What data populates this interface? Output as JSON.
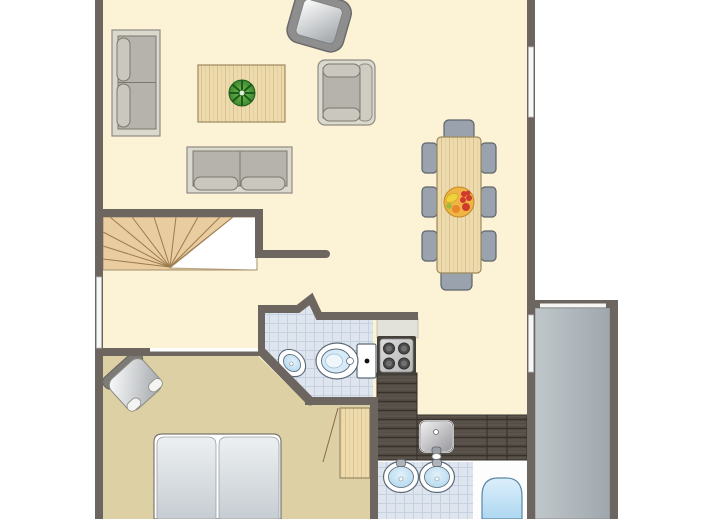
{
  "colors": {
    "white": "#ffffff",
    "wall": "#6d6560",
    "floorMain": "#fcf2d5",
    "floorBedroom": "#ddd0a4",
    "tileFloor": "#dfe5ee",
    "tileLine": "#c6d1e0",
    "terraceEdge": "#8d9499",
    "woodLight": "#eddbae",
    "woodGrain": "#c2a068",
    "stairsWood": "#e9cda0",
    "stairTread": "#9c7a4e",
    "counterDark": "#554e46",
    "counterSeam": "#332e29",
    "sofaFrame": "#dbd8ce",
    "sofaCushion": "#b6b3ac",
    "sofaPillow": "#cac7bf",
    "sofaEdge": "#7b786f",
    "chairGray": "#9aa3ad",
    "chairEdge": "#5d646c",
    "fixtureLine": "#5a6a78",
    "stoveDark": "#44403a",
    "burner": "#4c4c4c",
    "plantGreen": "#3f9e3f",
    "plantDark": "#1d5a1d",
    "bowl": "#f0b445",
    "bowlEdge": "#c08a28",
    "fruitRed": "#d03a2e",
    "fruitYellow": "#f2d23c",
    "fruitOrange": "#e8872c",
    "fruitGreen": "#a2b83a",
    "windowGlass": "#f7f7f7",
    "windowEdge": "#b9b9b9"
  },
  "objects": {
    "living_sofa_large": "two-seat sofa",
    "living_sofa_small": "two-seat sofa",
    "armchair": "armchair",
    "coffee_table": "coffee table",
    "plant": "plant",
    "tv": "corner tv",
    "dining_table": "dining table",
    "dining_chair": "dining chair",
    "fruit_bowl": "fruit bowl",
    "stairs": "winder staircase",
    "toilet": "toilet",
    "corner_sink": "corner hand basin",
    "stove": "cooktop",
    "kitchen_sink": "kitchen sink",
    "counter": "kitchen counter",
    "bed": "double bed",
    "bedroom_chair": "armchair",
    "door": "door leaf",
    "washbasin": "washbasin",
    "bathtub": "bathtub",
    "terrace": "storage room",
    "window": "window"
  }
}
